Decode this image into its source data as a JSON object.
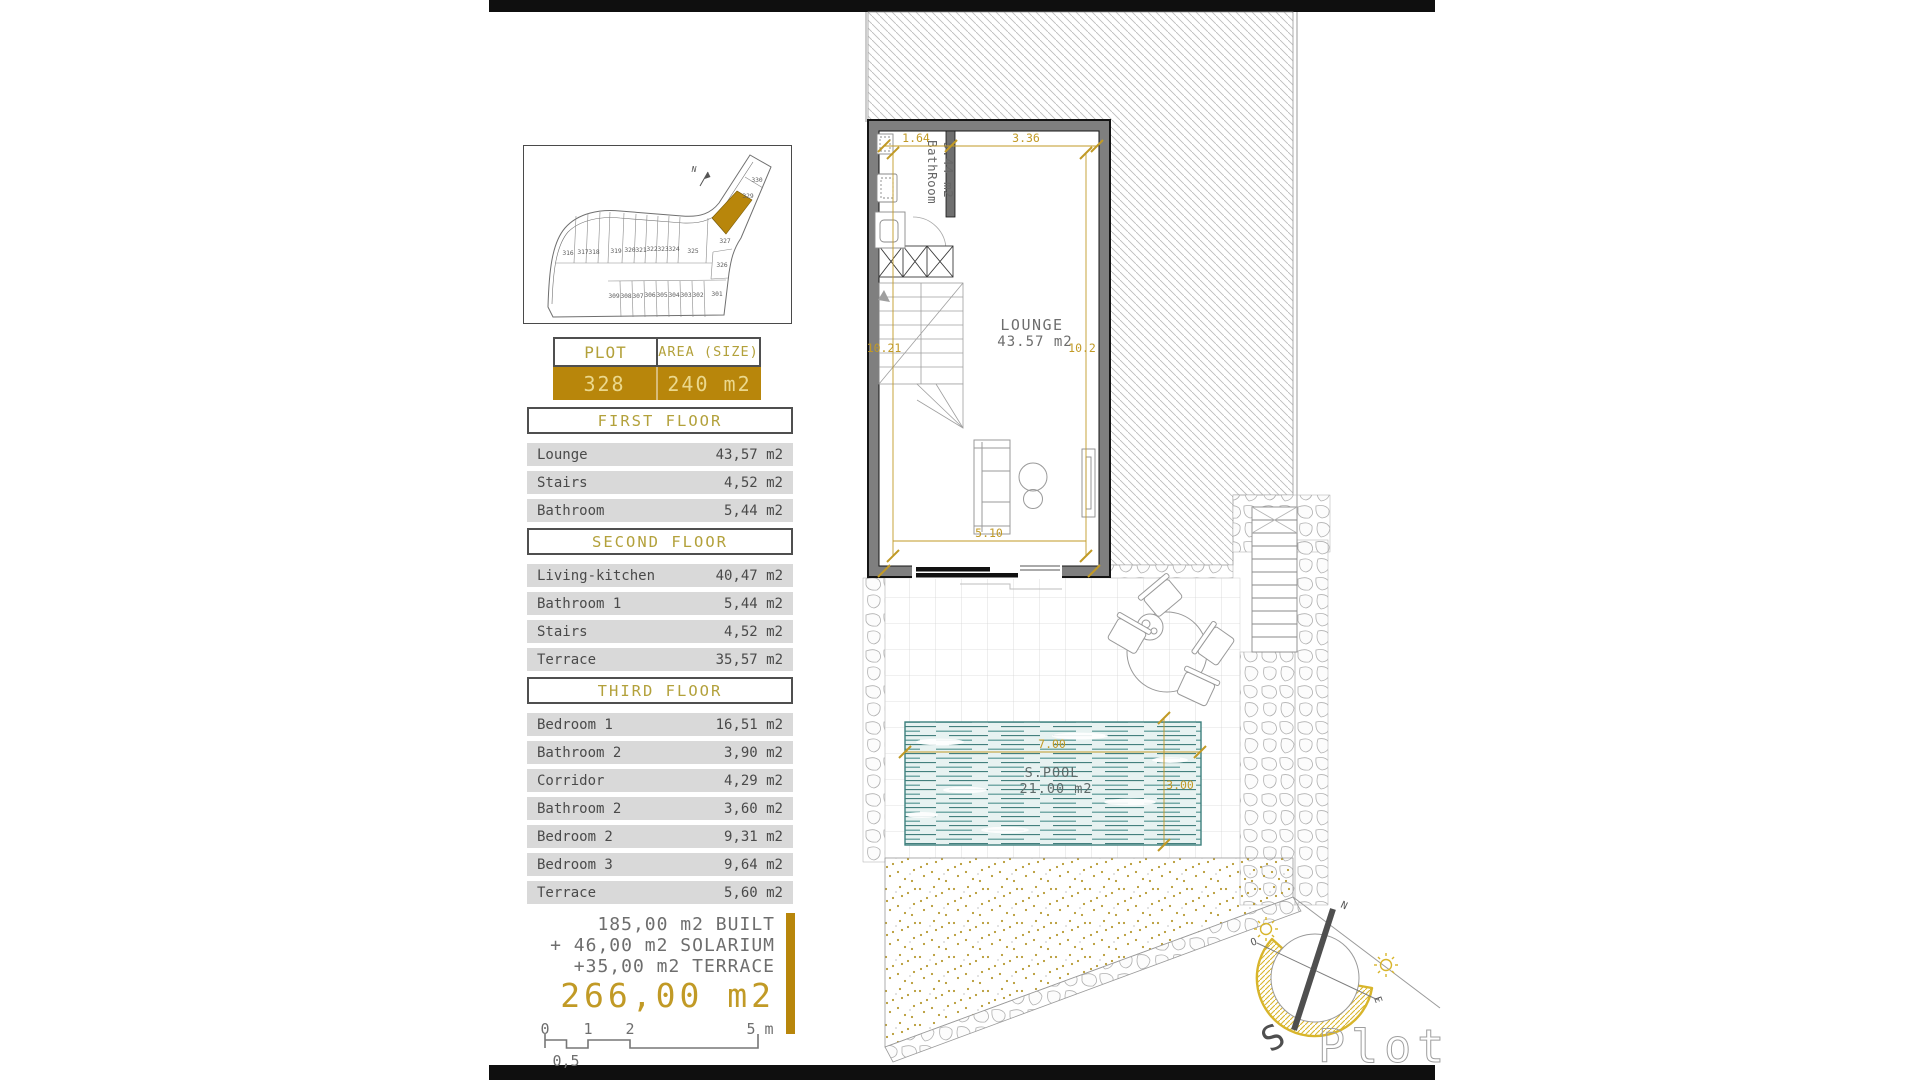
{
  "site_plan": {
    "north": "N",
    "top_row": [
      "316",
      "317",
      "318",
      "319",
      "320",
      "321",
      "322",
      "323",
      "324",
      "325"
    ],
    "bottom_row": [
      "309",
      "308",
      "307",
      "306",
      "305",
      "304",
      "303",
      "302",
      "301"
    ],
    "right_plots": [
      "327",
      "326"
    ],
    "arm_plots": [
      "329",
      "330"
    ],
    "highlight_color": "#B8860B"
  },
  "plot_table": {
    "headers": {
      "plot": "PLOT",
      "area": "AREA (SIZE)"
    },
    "values": {
      "plot": "328",
      "area": "240 m2"
    }
  },
  "floors": [
    {
      "title": "FIRST FLOOR",
      "rows": [
        {
          "label": "Lounge",
          "value": "43,57 m2"
        },
        {
          "label": "Stairs",
          "value": "4,52 m2"
        },
        {
          "label": "Bathroom",
          "value": "5,44 m2"
        }
      ]
    },
    {
      "title": "SECOND FLOOR",
      "rows": [
        {
          "label": "Living-kitchen",
          "value": "40,47 m2"
        },
        {
          "label": "Bathroom 1",
          "value": "5,44 m2"
        },
        {
          "label": "Stairs",
          "value": "4,52 m2"
        },
        {
          "label": "Terrace",
          "value": "35,57 m2"
        }
      ]
    },
    {
      "title": "THIRD FLOOR",
      "rows": [
        {
          "label": "Bedroom 1",
          "value": "16,51 m2"
        },
        {
          "label": "Bathroom 2",
          "value": "3,90 m2"
        },
        {
          "label": "Corridor",
          "value": "4,29 m2"
        },
        {
          "label": "Bathroom 2",
          "value": "3,60 m2"
        },
        {
          "label": "Bedroom 2",
          "value": "9,31 m2"
        },
        {
          "label": "Bedroom 3",
          "value": "9,64 m2"
        },
        {
          "label": "Terrace",
          "value": "5,60 m2"
        }
      ]
    }
  ],
  "summary": {
    "line1": "185,00 m2 BUILT",
    "line2": "+ 46,00 m2 SOLARIUM",
    "line3": "+35,00 m2 TERRACE",
    "total": "266,00 m2"
  },
  "scale_bar": {
    "t0": "0",
    "t1": "1",
    "t2": "2",
    "t5": "5 m",
    "half": "0,5"
  },
  "plan": {
    "bathroom": {
      "name": "BathRoom",
      "area": "5.44 m2"
    },
    "lounge": {
      "name": "LOUNGE",
      "area": "43.57 m2"
    },
    "dims": {
      "top_left": "1.64",
      "top_right": "3.36",
      "left": "10.21",
      "right": "10.2",
      "bottom": "5.10"
    },
    "pool": {
      "name": "S.POOL",
      "area": "21.00 m2",
      "width": "7.00",
      "depth": "3.00"
    }
  },
  "compass": {
    "n": "N",
    "s": "S",
    "o": "O",
    "e": "E",
    "brand": "Plot"
  },
  "colors": {
    "gold": "#B8860B",
    "gold_text": "#C19A26",
    "row_bg": "#D9D9D9"
  }
}
